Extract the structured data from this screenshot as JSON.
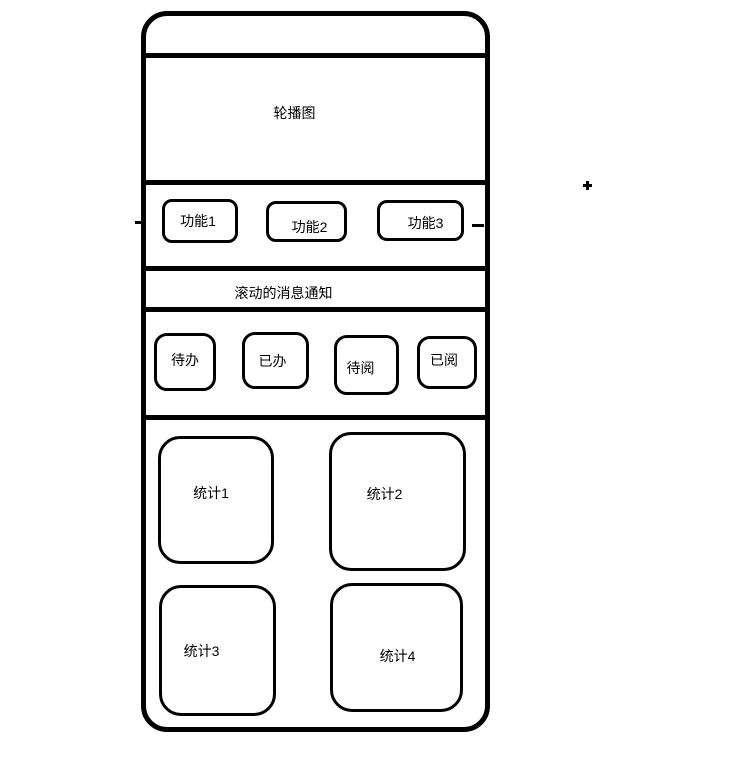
{
  "colors": {
    "stroke": "#000000",
    "background": "#ffffff"
  },
  "phone": {
    "status_bar": {
      "label": ""
    },
    "carousel": {
      "label": "轮播图"
    },
    "functions": [
      {
        "label": "功能1"
      },
      {
        "label": "功能2"
      },
      {
        "label": "功能3"
      }
    ],
    "notification": {
      "label": "滚动的消息通知"
    },
    "tasks": [
      {
        "label": "待办"
      },
      {
        "label": "已办"
      },
      {
        "label": "待阅"
      },
      {
        "label": "已阅"
      }
    ],
    "stats": [
      {
        "label": "统计1"
      },
      {
        "label": "统计2"
      },
      {
        "label": "统计3"
      },
      {
        "label": "统计4"
      }
    ]
  }
}
